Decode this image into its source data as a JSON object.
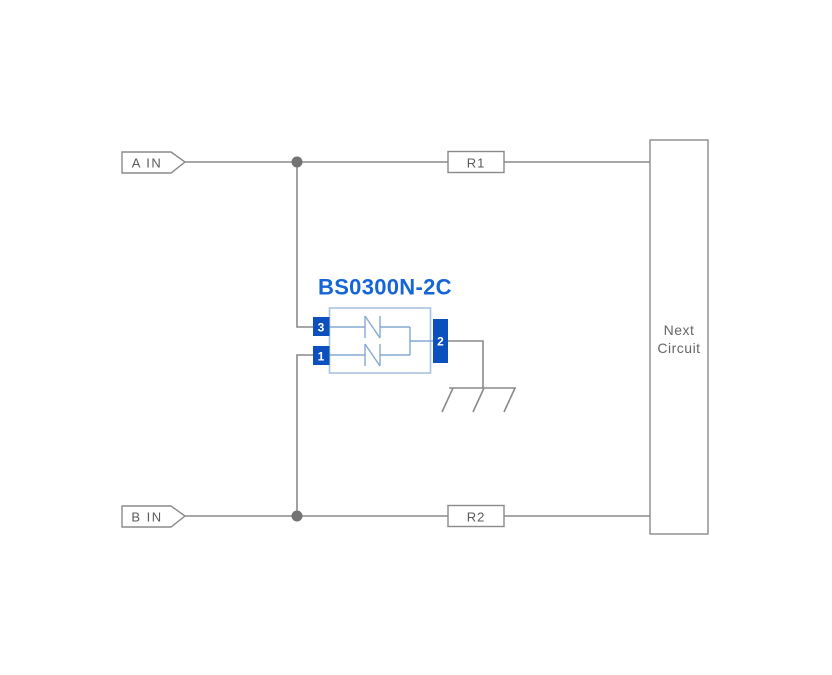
{
  "diagram": {
    "kind": "application-circuit-schematic",
    "component": {
      "part_number": "BS0300N-2C",
      "pin_3_label": "3",
      "pin_1_label": "1",
      "pin_2_label": "2"
    },
    "inputs": {
      "a_label": "A IN",
      "b_label": "B IN"
    },
    "resistors": {
      "r1_label": "R1",
      "r2_label": "R2"
    },
    "next_circuit": {
      "line1": "Next",
      "line2": "Circuit"
    },
    "colors": {
      "background": "#ffffff",
      "wire_gray": "#8a8a8a",
      "junction_gray": "#737373",
      "label_gray": "#5a5a5a",
      "next_circuit_gray": "#666666",
      "part_number_blue": "#1565d8",
      "pin_fill_blue": "#0b50bd",
      "component_outline_blue": "#a9c2e0",
      "symbol_line_blue": "#86a8d4"
    }
  }
}
